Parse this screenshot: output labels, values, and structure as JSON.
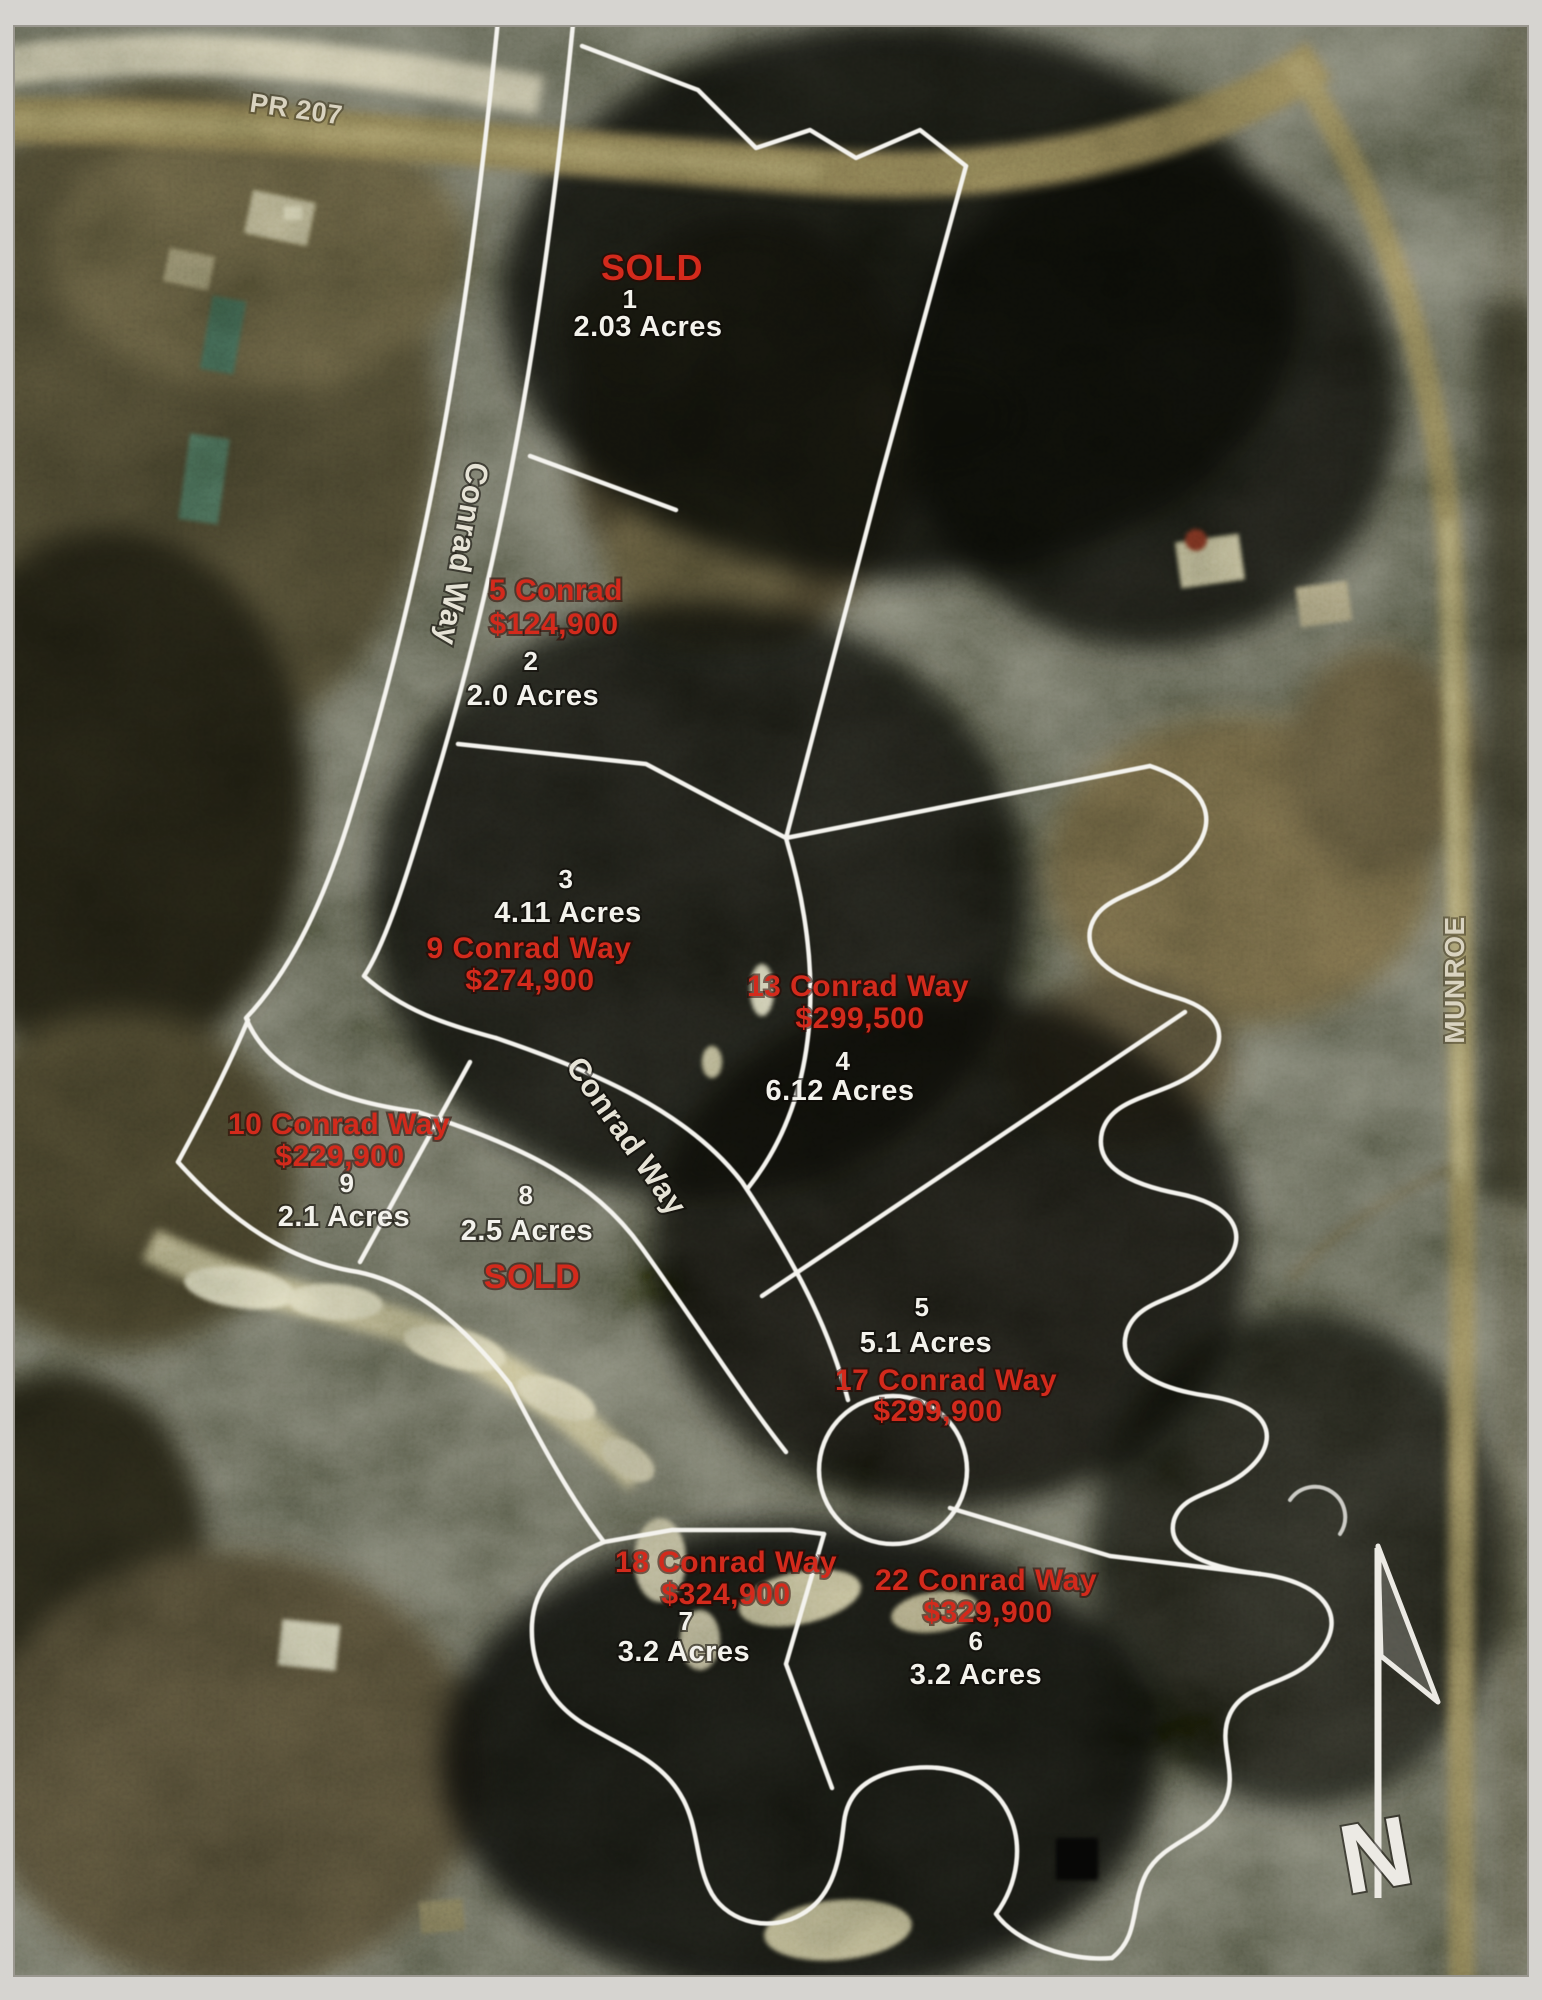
{
  "map": {
    "roads": {
      "top_left": "PR 207",
      "main_upper": "Conrad Way",
      "main_lower": "Conrad Way",
      "right": "MUNROE"
    },
    "compass": {
      "north": "N"
    },
    "colors": {
      "sold_red": "#d32a1c",
      "label_white": "#f3f2ec",
      "boundary_white": "#f4f3ee"
    },
    "lots": [
      {
        "number": "1",
        "acres": "2.03 Acres",
        "status": "SOLD"
      },
      {
        "number": "2",
        "acres": "2.0 Acres",
        "address": "5 Conrad",
        "price": "$124,900"
      },
      {
        "number": "3",
        "acres": "4.11 Acres",
        "address": "9 Conrad Way",
        "price": "$274,900"
      },
      {
        "number": "4",
        "acres": "6.12 Acres",
        "address": "13 Conrad Way",
        "price": "$299,500"
      },
      {
        "number": "5",
        "acres": "5.1 Acres",
        "address": "17 Conrad Way",
        "price": "$299,900"
      },
      {
        "number": "6",
        "acres": "3.2 Acres",
        "address": "22 Conrad Way",
        "price": "$329,900"
      },
      {
        "number": "7",
        "acres": "3.2 Acres",
        "address": "18 Conrad Way",
        "price": "$324,900"
      },
      {
        "number": "8",
        "acres": "2.5 Acres",
        "status": "SOLD"
      },
      {
        "number": "9",
        "acres": "2.1 Acres",
        "address": "10 Conrad Way",
        "price": "$229,900"
      }
    ]
  }
}
